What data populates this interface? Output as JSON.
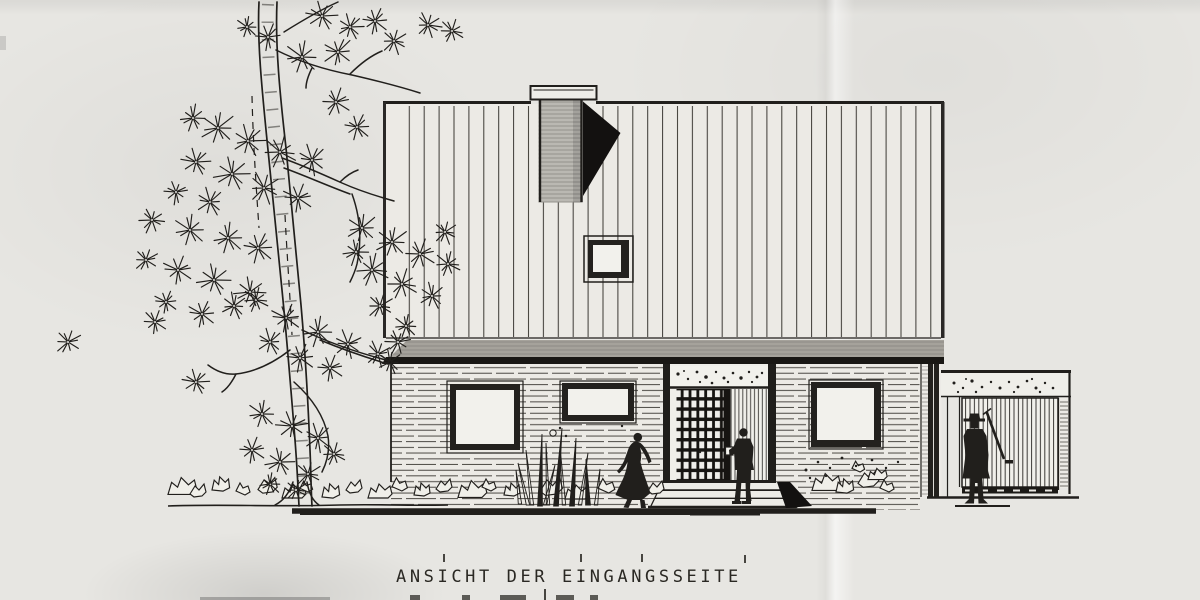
{
  "caption": {
    "line1": "ANSICHT DER EINGANGSSEITE"
  },
  "palette": {
    "paper": "#e7e6e2",
    "ink": "#211f1c",
    "shadow": "#131110",
    "glass": "#f2f1ec",
    "wall": "#eceae5",
    "chimney": "#bab8b2",
    "fascia": "#a5a29b"
  },
  "tree": {
    "needle_clusters": [
      [
        322,
        16,
        14
      ],
      [
        350,
        27,
        12
      ],
      [
        375,
        21,
        12
      ],
      [
        394,
        41,
        12
      ],
      [
        338,
        52,
        14
      ],
      [
        302,
        57,
        15
      ],
      [
        268,
        37,
        12
      ],
      [
        247,
        27,
        10
      ],
      [
        428,
        25,
        12
      ],
      [
        452,
        31,
        11
      ],
      [
        218,
        128,
        16
      ],
      [
        248,
        141,
        15
      ],
      [
        280,
        152,
        16
      ],
      [
        312,
        160,
        14
      ],
      [
        196,
        162,
        13
      ],
      [
        232,
        174,
        16
      ],
      [
        264,
        188,
        15
      ],
      [
        298,
        198,
        14
      ],
      [
        210,
        202,
        13
      ],
      [
        176,
        192,
        11
      ],
      [
        336,
        102,
        13
      ],
      [
        357,
        127,
        12
      ],
      [
        193,
        118,
        12
      ],
      [
        152,
        220,
        12
      ],
      [
        190,
        230,
        15
      ],
      [
        228,
        238,
        14
      ],
      [
        258,
        248,
        14
      ],
      [
        146,
        260,
        11
      ],
      [
        178,
        270,
        14
      ],
      [
        214,
        280,
        15
      ],
      [
        250,
        292,
        14
      ],
      [
        166,
        302,
        11
      ],
      [
        202,
        314,
        13
      ],
      [
        234,
        306,
        12
      ],
      [
        362,
        228,
        14
      ],
      [
        392,
        242,
        15
      ],
      [
        420,
        254,
        14
      ],
      [
        448,
        264,
        12
      ],
      [
        372,
        270,
        15
      ],
      [
        402,
        284,
        14
      ],
      [
        432,
        296,
        12
      ],
      [
        380,
        306,
        12
      ],
      [
        356,
        252,
        12
      ],
      [
        445,
        232,
        11
      ],
      [
        256,
        300,
        12
      ],
      [
        286,
        318,
        14
      ],
      [
        318,
        332,
        14
      ],
      [
        348,
        344,
        13
      ],
      [
        378,
        354,
        12
      ],
      [
        270,
        342,
        12
      ],
      [
        300,
        358,
        13
      ],
      [
        330,
        368,
        12
      ],
      [
        398,
        342,
        12
      ],
      [
        390,
        362,
        11
      ],
      [
        406,
        326,
        11
      ],
      [
        262,
        414,
        13
      ],
      [
        292,
        426,
        14
      ],
      [
        318,
        438,
        13
      ],
      [
        252,
        450,
        12
      ],
      [
        280,
        462,
        13
      ],
      [
        308,
        474,
        12
      ],
      [
        270,
        484,
        10
      ],
      [
        334,
        454,
        11
      ],
      [
        296,
        490,
        10
      ],
      [
        196,
        382,
        12
      ],
      [
        155,
        322,
        11
      ],
      [
        68,
        342,
        12
      ]
    ],
    "trunk_paths": [
      "M259,2 C257,40 262,90 267,140 C272,190 277,240 282,290 C287,340 291,390 295,440 C297,465 298,487 299,506",
      "M277,2 C275,45 280,95 286,148 C291,200 296,252 301,305 C305,350 308,400 310,450 C311,472 311,490 312,506"
    ],
    "bark_path": "M268,4 C266,46 271,96 276,148 C281,200 286,252 291,305 C296,355 300,410 303,460 C304,478 305,492 306,504",
    "branch_paths": [
      "M276,50 C300,62 326,70 352,75 C378,81 398,86 420,93",
      "M350,74 C360,64 370,56 382,51",
      "M284,32 C300,22 320,10 338,2",
      "M312,68 C308,76 306,82 306,88",
      "M282,158 C302,165 322,174 342,183 C360,191 376,196 394,201",
      "M284,168 C306,176 328,186 350,194",
      "M340,182 C346,176 352,172 358,170",
      "M352,194 C360,216 362,240 357,264 C355,272 352,278 350,282",
      "M290,350 C272,364 254,372 236,374 C226,375 216,371 208,365",
      "M236,374 C232,382 228,388 222,392",
      "M294,382 C312,398 324,416 328,436 C330,450 327,462 322,472",
      "M302,330 C332,344 362,354 390,361",
      "M320,340 C344,350 368,358 388,364",
      "M293,482 C289,494 283,501 275,505",
      "M307,482 C309,494 313,501 319,505"
    ],
    "dashed_paths": [
      "M252,96 C253,140 256,185 259,228",
      "M285,215 C287,255 290,295 292,335"
    ]
  },
  "ground": {
    "rocks": [
      [
        168,
        492,
        1.2,
        0
      ],
      [
        190,
        496,
        1.0,
        1
      ],
      [
        212,
        490,
        1.1,
        3
      ],
      [
        236,
        495,
        1.0,
        2
      ],
      [
        258,
        492,
        1.2,
        1
      ],
      [
        282,
        496,
        1.0,
        0
      ],
      [
        300,
        492,
        0.9,
        2
      ],
      [
        322,
        497,
        1.1,
        3
      ],
      [
        346,
        492,
        1.0,
        1
      ],
      [
        368,
        496,
        1.0,
        0
      ],
      [
        392,
        491,
        1.1,
        2
      ],
      [
        414,
        495,
        1.0,
        3
      ],
      [
        436,
        491,
        1.0,
        1
      ],
      [
        458,
        495,
        1.2,
        0
      ],
      [
        482,
        491,
        1.0,
        2
      ],
      [
        504,
        495,
        1.0,
        3
      ],
      [
        540,
        494,
        1.4,
        1
      ],
      [
        565,
        497,
        1.0,
        0
      ],
      [
        598,
        493,
        1.2,
        2
      ],
      [
        622,
        497,
        0.9,
        3
      ],
      [
        648,
        493,
        1.0,
        1
      ],
      [
        812,
        488,
        1.2,
        0
      ],
      [
        836,
        492,
        1.1,
        3
      ],
      [
        858,
        486,
        1.3,
        1
      ],
      [
        880,
        492,
        1.0,
        2
      ],
      [
        852,
        472,
        0.9,
        2
      ],
      [
        868,
        478,
        0.8,
        0
      ]
    ],
    "reeds": [
      [
        532,
        505,
        -6,
        55,
        0
      ],
      [
        540,
        506,
        2,
        72,
        1
      ],
      [
        548,
        505,
        -2,
        62,
        0
      ],
      [
        556,
        506,
        6,
        78,
        1
      ],
      [
        564,
        505,
        -4,
        58,
        0
      ],
      [
        572,
        506,
        4,
        68,
        1
      ],
      [
        580,
        505,
        8,
        52,
        0
      ],
      [
        588,
        505,
        -2,
        46,
        1
      ],
      [
        545,
        505,
        10,
        40,
        0
      ],
      [
        528,
        505,
        -10,
        42,
        0
      ],
      [
        596,
        505,
        4,
        36,
        0
      ],
      [
        520,
        504,
        -4,
        34,
        0
      ]
    ],
    "dots": [
      [
        806,
        470,
        1.5
      ],
      [
        818,
        462,
        1.3
      ],
      [
        830,
        468,
        1.2
      ],
      [
        842,
        458,
        1.4
      ],
      [
        856,
        466,
        1.2
      ],
      [
        872,
        460,
        1.3
      ],
      [
        886,
        468,
        1.2
      ],
      [
        898,
        462,
        1.2
      ],
      [
        810,
        478,
        1.2
      ],
      [
        826,
        476,
        1.1
      ],
      [
        560,
        428,
        1.2
      ],
      [
        566,
        436,
        1.2
      ],
      [
        622,
        426,
        1.2
      ],
      [
        700,
        452,
        1.2
      ]
    ]
  },
  "entry": {
    "transom_speckles": [
      [
        678,
        374,
        1.6
      ],
      [
        688,
        379,
        1.2
      ],
      [
        697,
        372,
        1.4
      ],
      [
        706,
        377,
        1.8
      ],
      [
        716,
        372,
        1.2
      ],
      [
        724,
        378,
        1.5
      ],
      [
        733,
        373,
        1.3
      ],
      [
        741,
        378,
        1.7
      ],
      [
        749,
        372,
        1.2
      ],
      [
        757,
        377,
        1.4
      ],
      [
        700,
        382,
        1.1
      ],
      [
        728,
        382,
        1.2
      ],
      [
        684,
        371,
        1.0
      ],
      [
        712,
        383,
        1.3
      ],
      [
        752,
        382,
        1.1
      ],
      [
        762,
        373,
        1.2
      ]
    ]
  },
  "garage": {
    "speckles": [
      [
        954,
        383,
        1.5
      ],
      [
        963,
        388,
        1.2
      ],
      [
        972,
        381,
        1.6
      ],
      [
        982,
        387,
        1.3
      ],
      [
        991,
        382,
        1.2
      ],
      [
        1000,
        388,
        1.5
      ],
      [
        1009,
        382,
        1.2
      ],
      [
        1018,
        387,
        1.4
      ],
      [
        1027,
        381,
        1.3
      ],
      [
        1036,
        388,
        1.5
      ],
      [
        1045,
        383,
        1.2
      ],
      [
        1053,
        388,
        1.3
      ],
      [
        958,
        392,
        1.1
      ],
      [
        976,
        392,
        1.2
      ],
      [
        1014,
        392,
        1.1
      ],
      [
        1040,
        392,
        1.2
      ],
      [
        966,
        379,
        1.0
      ],
      [
        1032,
        379,
        1.1
      ]
    ]
  }
}
